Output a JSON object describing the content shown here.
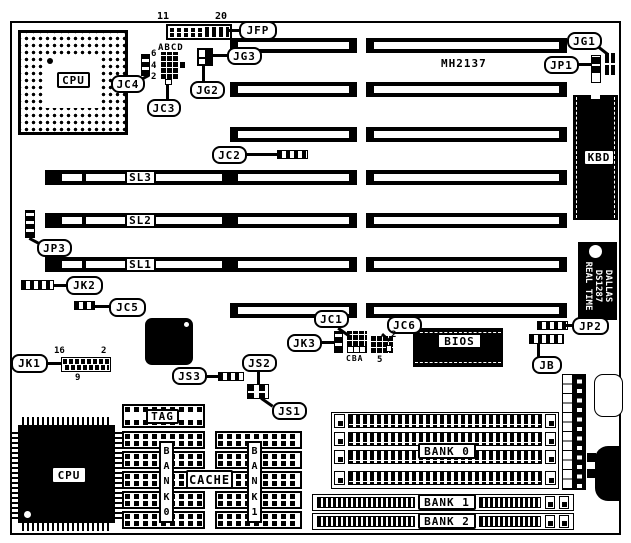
{
  "board": {
    "part_number": "MH2137"
  },
  "callouts": {
    "jfp": "JFP",
    "jg1": "JG1",
    "jp1": "JP1",
    "jg2": "JG2",
    "jg3": "JG3",
    "jc4": "JC4",
    "jc3": "JC3",
    "jc2": "JC2",
    "jc1": "JC1",
    "jc5": "JC5",
    "jc6": "JC6",
    "jp2": "JP2",
    "jp3": "JP3",
    "jb": "JB",
    "jk1": "JK1",
    "jk2": "JK2",
    "jk3": "JK3",
    "js1": "JS1",
    "js2": "JS2",
    "js3": "JS3"
  },
  "chips": {
    "cpu_socket": "CPU",
    "cpu_qfp": "CPU",
    "kbd": "KBD",
    "bios": "BIOS",
    "tag": "TAG",
    "cache": "CACHE",
    "bank0_column": "BANK0",
    "bank1_column": "BANK1",
    "rtc_brand": "DALLAS",
    "rtc_part": "DS1287",
    "rtc_type": "REAL TIME"
  },
  "slots": {
    "sl1": "SL1",
    "sl2": "SL2",
    "sl3": "SL3"
  },
  "memory_banks": {
    "bank0": "BANK 0",
    "bank1": "BANK 1",
    "bank2": "BANK 2"
  },
  "pin_numbers": {
    "jfp_first": "11",
    "jfp_last": "20",
    "jc3_columns": "ABCD",
    "jc4_pins": {
      "p6": "6",
      "p4": "4",
      "p2": "2"
    },
    "jk1": {
      "top_left": "16",
      "top_right": "2",
      "bottom": "9"
    },
    "jc1_columns": "CBA",
    "jc6": {
      "top": "2",
      "bottom": "5"
    }
  }
}
